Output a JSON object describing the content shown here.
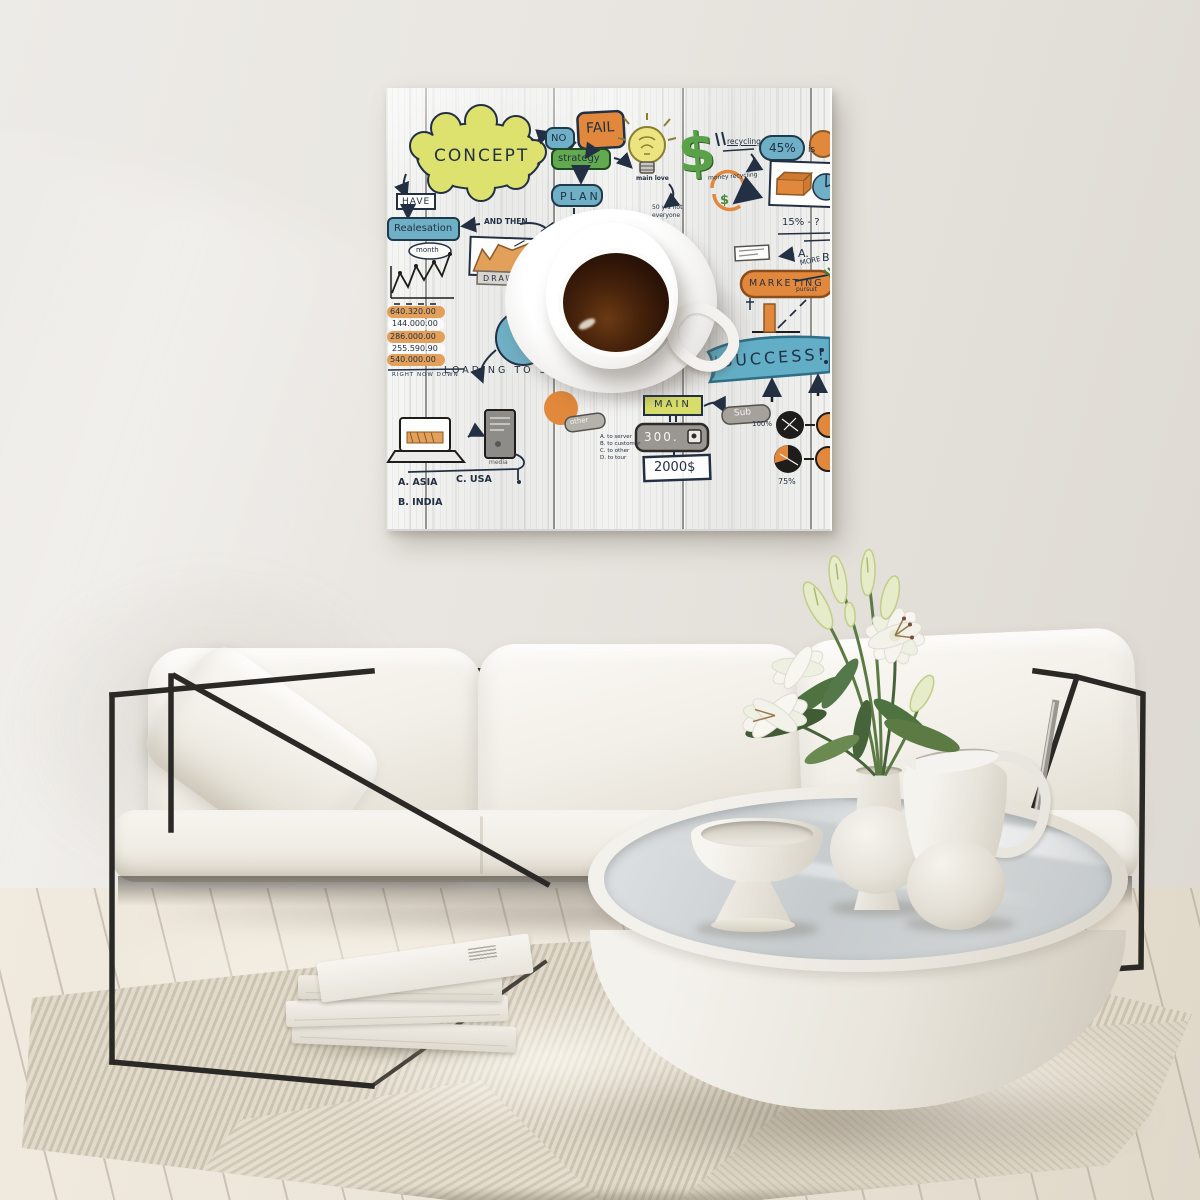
{
  "scene": {
    "description": "Bright living room: square canvas print of a top-view coffee cup on white wooden boards covered with colorful business-plan doodles, hanging above a white sofa with a black wire frame, round white coffee table with ceramic vases and white lilies, beige woven rug on light wood floor"
  },
  "palette": {
    "accent_blue": "#6fb0c6",
    "accent_orange": "#e2883c",
    "accent_green": "#63a94f",
    "accent_yellow": "#dde26e",
    "ink_navy": "#233043",
    "coffee_brown": "#2e1608"
  },
  "artwork": {
    "concept": "CONCEPT",
    "have": "HAVE",
    "realisation": "Realesation",
    "month": "month",
    "and_then": "AND THEN...",
    "pct46": "46%",
    "draw": "DRAW",
    "numbers": [
      "640.320.00",
      "144.000.00",
      "286.000.00",
      "255.590.90",
      "540.000.00"
    ],
    "numbers_note": "RIGHT NOW DOWN",
    "loading": "LOADING TO SERVER",
    "media": "media",
    "region_a": "A. ASIA",
    "region_b": "B. INDIA",
    "region_c": "C. USA",
    "no": "NO",
    "fail": "FAIL",
    "strategy": "strategy",
    "plan": "PLAN",
    "bulb_note": "main love",
    "years_note": "50 yrs not everyone",
    "dollar": "$",
    "recycling": "recycling",
    "money_recycling": "money recycling",
    "pct45": "45%",
    "is": "is",
    "pct15": "15% - ?",
    "letter_a": "A.",
    "letter_b": "B.",
    "marketing": "MARKETING",
    "more": "MORE",
    "pursuit": "pursuit",
    "success": "SUCCESS!",
    "main": "MAIN",
    "n300": "300.",
    "sub": "Sub",
    "n2000": "2000$",
    "delivery_list": [
      "A. to server",
      "B. to customer",
      "C. to other",
      "D. to tour"
    ],
    "other": "other",
    "pct100": "100%",
    "pct75": "75%"
  }
}
